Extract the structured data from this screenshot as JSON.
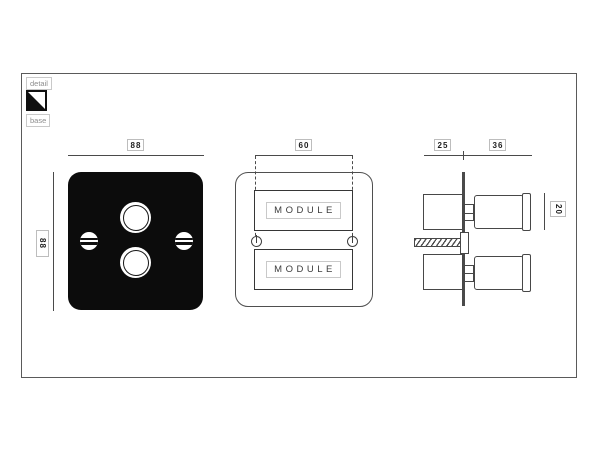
{
  "legend": {
    "detail": "detail",
    "base": "base",
    "icon": "diagonal-split-square-icon"
  },
  "front_view": {
    "width_dim": "88",
    "height_dim": "88"
  },
  "module_view": {
    "width_dim": "60",
    "modules": [
      "MODULE",
      "MODULE"
    ]
  },
  "side_view": {
    "back_depth_dim": "25",
    "front_depth_dim": "36",
    "knob_height_dim": "20"
  },
  "colors": {
    "line": "#4a4a4a",
    "plate_black": "#0c0c0c",
    "label_border": "#bdbdbd",
    "legend_text": "#8e8e8e",
    "background": "#ffffff"
  }
}
